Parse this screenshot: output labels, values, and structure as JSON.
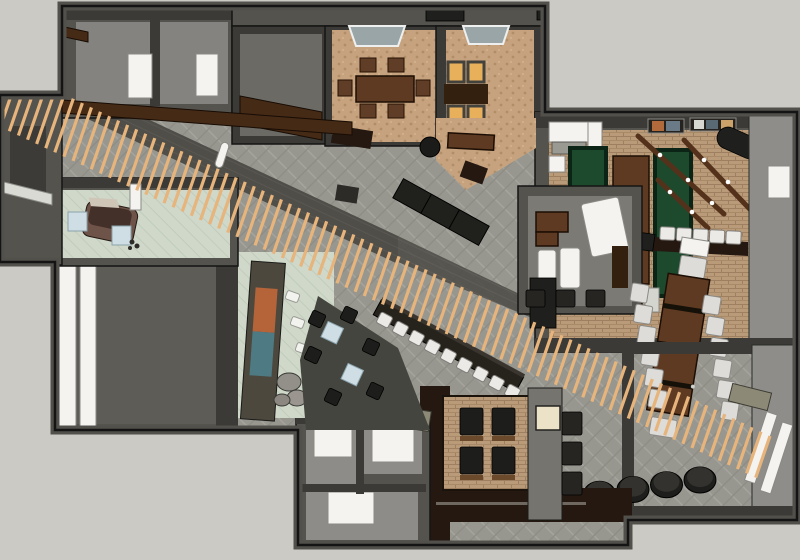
{
  "meta": {
    "kind": "3d-floorplan-render",
    "description": "Top-down 3D cutaway render of a restaurant and lounge interior with a diagonal timber-slat canopy crossing the plan",
    "canvas": {
      "width": 800,
      "height": 560
    },
    "visible_text": []
  },
  "colors": {
    "bg": "#cbcac4",
    "outline": "#141414",
    "wall": "#55534e",
    "wallDark": "#3b3a36",
    "wallLight": "#8e8d89",
    "roomFloor": "#84837f",
    "carpet": "#98978f",
    "walkway": "#504e49",
    "slat": "#e7b47c",
    "beam": "#452a16",
    "walnut": "#5d3a21",
    "walnutDark": "#33200f",
    "walnutDark2": "#241811",
    "tan": "#c6a37e",
    "brick": "#b99b79",
    "mint": "#cfd8c9",
    "felt": "#1d4a2d",
    "amber": "#e9b05c",
    "glass": "#9aa5a8",
    "white": "#f4f3f0",
    "lightBlue": "#cfdde4",
    "olive": "#8c8a76",
    "cream": "#ece2c8",
    "blackish": "#1f1f1d",
    "ottoman": "#1e1e1c",
    "paintingA": "#b5643a",
    "paintingB": "#4e7a84",
    "chairBrown": "#5f3d26"
  },
  "inventory": {
    "wood_slats": 85,
    "pool_tables_green": 2,
    "shuffleboard_tables": 1,
    "games_bar_stools": 5,
    "hall_bar_stools": 9,
    "conference_chairs": 13,
    "round_ottomans": 5,
    "alcove_armchairs": 4,
    "dining_chairs_room1": 6,
    "amber_booth_chairs": 4,
    "lounge_coffee_tables": 2,
    "restroom_cubicles": 3
  },
  "generated": {
    "slats": {
      "mode": "slats",
      "name": "wood-slat",
      "count": 85,
      "x1": 10,
      "y1": 68,
      "x2": 770,
      "y2": 436,
      "len1": 58,
      "len2": 44,
      "lean_deg": 19,
      "width": 3.2
    },
    "hall_bar_stools": {
      "mode": "rects",
      "name": "bar-stool-white",
      "cls": "seat-white",
      "count": 9,
      "x1": 378,
      "y1": 314,
      "x2": 506,
      "y2": 386,
      "w": 13,
      "h": 12,
      "rot": 28
    },
    "games_bar_stools": {
      "mode": "rects",
      "name": "bar-stool-white",
      "cls": "seat-white",
      "count": 5,
      "x1": 660,
      "y1": 227,
      "x2": 726,
      "y2": 231,
      "w": 15,
      "h": 13,
      "rot": 3
    },
    "conference_chairs_left": {
      "mode": "rects",
      "name": "conference-chair",
      "cls": "chair-light",
      "count": 6,
      "x1": 631,
      "y1": 284,
      "x2": 649,
      "y2": 390,
      "w": 17,
      "h": 18,
      "rot": 9
    },
    "conference_chairs_right": {
      "mode": "rects",
      "name": "conference-chair",
      "cls": "chair-light",
      "count": 6,
      "x1": 703,
      "y1": 296,
      "x2": 721,
      "y2": 402,
      "w": 17,
      "h": 18,
      "rot": 9
    },
    "ottomans": {
      "mode": "ottomans",
      "name": "round-ottoman",
      "count": 5,
      "x1": 566,
      "y1": 499,
      "x2": 700,
      "y2": 480,
      "rx": 16,
      "ry": 13
    },
    "alcove_chairs": {
      "mode": "rects",
      "name": "lounge-armchair",
      "cls": "chair-black",
      "points": [
        [
          460,
          408
        ],
        [
          492,
          408
        ],
        [
          460,
          447
        ],
        [
          492,
          447
        ]
      ],
      "w": 23,
      "h": 27,
      "rot": 0
    },
    "office_stools": {
      "mode": "rects",
      "name": "stool-dark",
      "cls": "stool-dark",
      "points": [
        [
          526,
          290
        ],
        [
          556,
          290
        ],
        [
          586,
          290
        ]
      ],
      "w": 19,
      "h": 17,
      "rot": 0
    },
    "bar_side_chairs": {
      "mode": "rects",
      "name": "bar-chair-dark",
      "cls": "stool-dark",
      "points": [
        [
          562,
          412
        ],
        [
          562,
          442
        ],
        [
          562,
          472
        ]
      ],
      "w": 20,
      "h": 23,
      "rot": 0
    },
    "lounge_chairs": {
      "mode": "rects",
      "name": "lounge-chair",
      "cls": "chair-black",
      "points": [
        [
          310,
          312
        ],
        [
          342,
          308
        ],
        [
          306,
          348
        ],
        [
          364,
          340
        ],
        [
          326,
          390
        ],
        [
          368,
          384
        ]
      ],
      "w": 14,
      "h": 14,
      "rot": 25
    },
    "mint_benches": {
      "mode": "rects",
      "name": "bench-white",
      "cls": "bench-white",
      "points": [
        [
          286,
          292
        ],
        [
          291,
          318
        ],
        [
          296,
          344
        ]
      ],
      "w": 13,
      "h": 9,
      "rot": 20
    }
  }
}
